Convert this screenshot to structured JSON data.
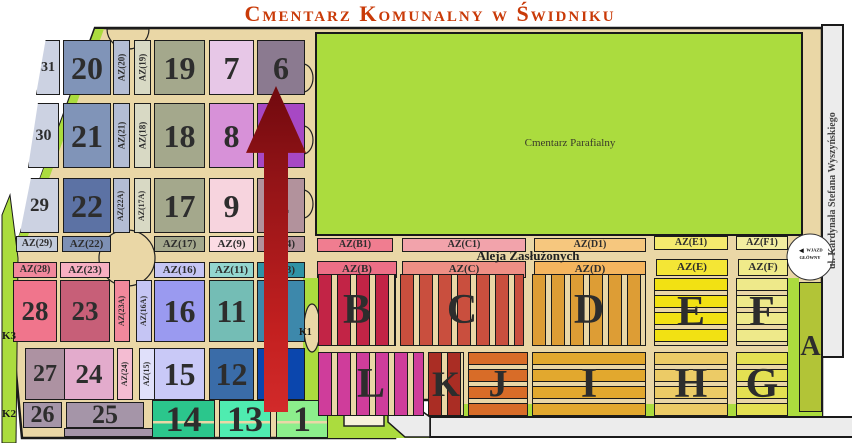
{
  "title": "Cmentarz Komunalny w Świdniku",
  "labels": {
    "parish": "Cmentarz Parafialny",
    "street_right": "ul. Kardynała Stefana Wyszyńskiego",
    "alley": "Aleja Zasłużonych",
    "entrance": "WJAZD GŁÓWNY",
    "gate_k1": "K1",
    "gate_k2": "K2",
    "gate_k3": "K3"
  },
  "colors": {
    "title": "#c93a08",
    "road_tan": "#ead7a6",
    "grass_green": "#abdc3e",
    "outline": "#1a1a1a",
    "road_gray": "#ececec",
    "arrow_red": "#c32020",
    "chapel": "#f8f1da"
  },
  "sections": [
    {
      "id": "31",
      "label": "31",
      "x": 36,
      "y": 40,
      "w": 24,
      "h": 55,
      "bg": "#ccd2e2",
      "fs": 14,
      "cp": "polygon(40% 0,100% 0,100% 100%,0 100%)"
    },
    {
      "id": "20",
      "label": "20",
      "x": 63,
      "y": 40,
      "w": 48,
      "h": 55,
      "bg": "#8094b8",
      "fs": 32
    },
    {
      "id": "az20",
      "label": "AZ(20)",
      "x": 113,
      "y": 40,
      "w": 17,
      "h": 55,
      "bg": "#b4bdd4",
      "fs": 9,
      "vert": true
    },
    {
      "id": "az19",
      "label": "AZ(19)",
      "x": 134,
      "y": 40,
      "w": 17,
      "h": 55,
      "bg": "#d8d9c4",
      "fs": 9,
      "vert": true
    },
    {
      "id": "19",
      "label": "19",
      "x": 154,
      "y": 40,
      "w": 51,
      "h": 55,
      "bg": "#a4a88c",
      "fs": 32
    },
    {
      "id": "7",
      "label": "7",
      "x": 209,
      "y": 40,
      "w": 45,
      "h": 55,
      "bg": "#e7c7e7",
      "fs": 32
    },
    {
      "id": "6",
      "label": "6",
      "x": 257,
      "y": 40,
      "w": 48,
      "h": 55,
      "bg": "#8b7a90",
      "fs": 32
    },
    {
      "id": "30",
      "label": "30",
      "x": 28,
      "y": 103,
      "w": 31,
      "h": 65,
      "bg": "#ccd2e2",
      "fs": 16,
      "cp": "polygon(32% 0,100% 0,100% 100%,0 100%)"
    },
    {
      "id": "21",
      "label": "21",
      "x": 63,
      "y": 103,
      "w": 48,
      "h": 65,
      "bg": "#8094b8",
      "fs": 32
    },
    {
      "id": "az21",
      "label": "AZ(21)",
      "x": 113,
      "y": 103,
      "w": 17,
      "h": 65,
      "bg": "#b4bdd4",
      "fs": 9,
      "vert": true
    },
    {
      "id": "az18",
      "label": "AZ(18)",
      "x": 134,
      "y": 103,
      "w": 17,
      "h": 65,
      "bg": "#d8d9c4",
      "fs": 9,
      "vert": true
    },
    {
      "id": "18",
      "label": "18",
      "x": 154,
      "y": 103,
      "w": 51,
      "h": 65,
      "bg": "#a4a88c",
      "fs": 32
    },
    {
      "id": "8",
      "label": "8",
      "x": 209,
      "y": 103,
      "w": 45,
      "h": 65,
      "bg": "#d791d8",
      "fs": 32
    },
    {
      "id": "5",
      "label": "",
      "x": 257,
      "y": 103,
      "w": 48,
      "h": 65,
      "bg": "#a748c4",
      "fs": 32
    },
    {
      "id": "29",
      "label": "29",
      "x": 20,
      "y": 178,
      "w": 39,
      "h": 55,
      "bg": "#ccd2e2",
      "fs": 19,
      "cp": "polygon(28% 0,100% 0,100% 100%,0 100%)"
    },
    {
      "id": "22",
      "label": "22",
      "x": 63,
      "y": 178,
      "w": 48,
      "h": 55,
      "bg": "#5c72a4",
      "fs": 32
    },
    {
      "id": "az22a",
      "label": "AZ(22A)",
      "x": 113,
      "y": 178,
      "w": 17,
      "h": 55,
      "bg": "#b4bdd4",
      "fs": 8,
      "vert": true
    },
    {
      "id": "az17a",
      "label": "AZ(17A)",
      "x": 134,
      "y": 178,
      "w": 17,
      "h": 55,
      "bg": "#d8d9c4",
      "fs": 8,
      "vert": true
    },
    {
      "id": "17",
      "label": "17",
      "x": 154,
      "y": 178,
      "w": 51,
      "h": 55,
      "bg": "#a4a88c",
      "fs": 32
    },
    {
      "id": "9",
      "label": "9",
      "x": 209,
      "y": 178,
      "w": 45,
      "h": 55,
      "bg": "#f7d4de",
      "fs": 32
    },
    {
      "id": "4",
      "label": "4",
      "x": 257,
      "y": 178,
      "w": 48,
      "h": 55,
      "bg": "#b2929c",
      "fs": 32
    },
    {
      "id": "az29",
      "label": "AZ(29)",
      "x": 16,
      "y": 236,
      "w": 42,
      "h": 16,
      "bg": "#c2cbdc",
      "fs": 10
    },
    {
      "id": "az22",
      "label": "AZ(22)",
      "x": 62,
      "y": 236,
      "w": 49,
      "h": 16,
      "bg": "#7d90b5",
      "fs": 11
    },
    {
      "id": "az17",
      "label": "AZ(17)",
      "x": 154,
      "y": 236,
      "w": 51,
      "h": 16,
      "bg": "#a4a88c",
      "fs": 11
    },
    {
      "id": "az9",
      "label": "AZ(9)",
      "x": 209,
      "y": 236,
      "w": 45,
      "h": 16,
      "bg": "#fbdce4",
      "fs": 11
    },
    {
      "id": "az4",
      "label": "AZ(4)",
      "x": 257,
      "y": 236,
      "w": 48,
      "h": 16,
      "bg": "#b2929c",
      "fs": 11
    },
    {
      "id": "azb1",
      "label": "AZ(B1)",
      "x": 317,
      "y": 238,
      "w": 76,
      "h": 14,
      "bg": "#f07d90",
      "fs": 10
    },
    {
      "id": "azc1",
      "label": "AZ(C1)",
      "x": 402,
      "y": 238,
      "w": 124,
      "h": 14,
      "bg": "#f2a3ab",
      "fs": 10
    },
    {
      "id": "azd1",
      "label": "AZ(D1)",
      "x": 534,
      "y": 238,
      "w": 112,
      "h": 14,
      "bg": "#f6c77e",
      "fs": 10
    },
    {
      "id": "aze1",
      "label": "AZ(E1)",
      "x": 654,
      "y": 236,
      "w": 74,
      "h": 14,
      "bg": "#f4ea6e",
      "fs": 10
    },
    {
      "id": "azf1",
      "label": "AZ(F1)",
      "x": 736,
      "y": 236,
      "w": 52,
      "h": 14,
      "bg": "#f2eda0",
      "fs": 10
    },
    {
      "id": "az28",
      "label": "AZ(28)",
      "x": 13,
      "y": 262,
      "w": 44,
      "h": 16,
      "bg": "#f0889c",
      "fs": 10
    },
    {
      "id": "az23",
      "label": "AZ(23)",
      "x": 60,
      "y": 262,
      "w": 50,
      "h": 16,
      "bg": "#f7afc2",
      "fs": 11
    },
    {
      "id": "az16",
      "label": "AZ(16)",
      "x": 154,
      "y": 262,
      "w": 51,
      "h": 16,
      "bg": "#c5c5f4",
      "fs": 11
    },
    {
      "id": "az11",
      "label": "AZ(11)",
      "x": 209,
      "y": 262,
      "w": 45,
      "h": 16,
      "bg": "#93d6cf",
      "fs": 11
    },
    {
      "id": "az3",
      "label": "AZ(3)",
      "x": 257,
      "y": 262,
      "w": 48,
      "h": 16,
      "bg": "#2e93a6",
      "fs": 11
    },
    {
      "id": "azb",
      "label": "AZ(B)",
      "x": 317,
      "y": 261,
      "w": 80,
      "h": 17,
      "bg": "#ec6f86",
      "fs": 11
    },
    {
      "id": "azc",
      "label": "AZ(C)",
      "x": 402,
      "y": 261,
      "w": 124,
      "h": 17,
      "bg": "#ee8f85",
      "fs": 11
    },
    {
      "id": "azd",
      "label": "AZ(D)",
      "x": 534,
      "y": 261,
      "w": 112,
      "h": 17,
      "bg": "#f5b55e",
      "fs": 11
    },
    {
      "id": "aze",
      "label": "AZ(E)",
      "x": 656,
      "y": 259,
      "w": 72,
      "h": 17,
      "bg": "#f4e635",
      "fs": 11
    },
    {
      "id": "azf",
      "label": "AZ(F)",
      "x": 738,
      "y": 259,
      "w": 50,
      "h": 17,
      "bg": "#f0ea8a",
      "fs": 11
    },
    {
      "id": "28",
      "label": "28",
      "x": 13,
      "y": 280,
      "w": 44,
      "h": 62,
      "bg": "#f0758c",
      "fs": 27
    },
    {
      "id": "23",
      "label": "23",
      "x": 60,
      "y": 280,
      "w": 50,
      "h": 62,
      "bg": "#c75f78",
      "fs": 27
    },
    {
      "id": "az23a",
      "label": "AZ(23A)",
      "x": 114,
      "y": 280,
      "w": 16,
      "h": 62,
      "bg": "#f2889c",
      "fs": 8,
      "vert": true
    },
    {
      "id": "az16a",
      "label": "AZ(16A)",
      "x": 136,
      "y": 280,
      "w": 16,
      "h": 62,
      "bg": "#c5c5f4",
      "fs": 8,
      "vert": true
    },
    {
      "id": "16",
      "label": "16",
      "x": 154,
      "y": 280,
      "w": 51,
      "h": 62,
      "bg": "#9a9af0",
      "fs": 32
    },
    {
      "id": "11",
      "label": "11",
      "x": 209,
      "y": 280,
      "w": 45,
      "h": 62,
      "bg": "#74bdb5",
      "fs": 32
    },
    {
      "id": "3",
      "label": "3",
      "x": 257,
      "y": 280,
      "w": 48,
      "h": 62,
      "bg": "#3d88ab",
      "fs": 32
    },
    {
      "id": "27",
      "label": "27",
      "x": 25,
      "y": 348,
      "w": 40,
      "h": 52,
      "bg": "#ad92a2",
      "fs": 24
    },
    {
      "id": "24",
      "label": "24",
      "x": 64,
      "y": 348,
      "w": 50,
      "h": 52,
      "bg": "#e3abcc",
      "fs": 27
    },
    {
      "id": "az24",
      "label": "AZ(24)",
      "x": 117,
      "y": 348,
      "w": 16,
      "h": 52,
      "bg": "#f4bcd2",
      "fs": 8,
      "vert": true
    },
    {
      "id": "az15",
      "label": "AZ(15)",
      "x": 139,
      "y": 348,
      "w": 16,
      "h": 52,
      "bg": "#e0e0fa",
      "fs": 8,
      "vert": true
    },
    {
      "id": "15",
      "label": "15",
      "x": 154,
      "y": 348,
      "w": 51,
      "h": 52,
      "bg": "#c9c9f7",
      "fs": 32
    },
    {
      "id": "12",
      "label": "12",
      "x": 209,
      "y": 348,
      "w": 45,
      "h": 52,
      "bg": "#3a6ca8",
      "fs": 32
    },
    {
      "id": "2",
      "label": "2",
      "x": 257,
      "y": 348,
      "w": 48,
      "h": 52,
      "bg": "#0b46ad",
      "fs": 32
    },
    {
      "id": "26",
      "label": "26",
      "x": 23,
      "y": 402,
      "w": 39,
      "h": 26,
      "bg": "#a595a8",
      "fs": 24
    },
    {
      "id": "25",
      "label": "25",
      "x": 66,
      "y": 402,
      "w": 78,
      "h": 26,
      "bg": "#a595a8",
      "fs": 26
    },
    {
      "id": "25a",
      "label": "",
      "x": 64,
      "y": 428,
      "w": 148,
      "h": 9,
      "bg": "#a595a8",
      "fs": 8
    },
    {
      "id": "14",
      "label": "14",
      "x": 152,
      "y": 400,
      "w": 63,
      "h": 38,
      "bg": "#2bc68c",
      "fs": 36,
      "split": true
    },
    {
      "id": "13",
      "label": "13",
      "x": 219,
      "y": 400,
      "w": 52,
      "h": 38,
      "bg": "#4fecb0",
      "fs": 36,
      "split": true
    },
    {
      "id": "1",
      "label": "1",
      "x": 276,
      "y": 400,
      "w": 52,
      "h": 38,
      "bg": "#8cee8c",
      "fs": 36,
      "split": true
    },
    {
      "id": "B",
      "label": "B",
      "x": 318,
      "y": 274,
      "w": 78,
      "h": 72,
      "bg": "#c22446",
      "fs": 42,
      "stripe": "v"
    },
    {
      "id": "C",
      "label": "C",
      "x": 400,
      "y": 274,
      "w": 124,
      "h": 72,
      "bg": "#c94f3e",
      "fs": 42,
      "stripe": "v"
    },
    {
      "id": "D",
      "label": "D",
      "x": 532,
      "y": 274,
      "w": 114,
      "h": 72,
      "bg": "#dd9d35",
      "fs": 42,
      "stripe": "v"
    },
    {
      "id": "E",
      "label": "E",
      "x": 654,
      "y": 278,
      "w": 74,
      "h": 68,
      "bg": "#f2e113",
      "fs": 42,
      "stripe": "h"
    },
    {
      "id": "F",
      "label": "F",
      "x": 736,
      "y": 278,
      "w": 52,
      "h": 68,
      "bg": "#eee98a",
      "fs": 42,
      "stripe": "h"
    },
    {
      "id": "L",
      "label": "L",
      "x": 318,
      "y": 352,
      "w": 106,
      "h": 64,
      "bg": "#cf3d9b",
      "fs": 42,
      "stripe": "v"
    },
    {
      "id": "K",
      "label": "K",
      "x": 428,
      "y": 352,
      "w": 36,
      "h": 64,
      "bg": "#aa2d24",
      "fs": 36,
      "stripe": "v"
    },
    {
      "id": "J",
      "label": "J",
      "x": 468,
      "y": 352,
      "w": 60,
      "h": 64,
      "bg": "#d86c28",
      "fs": 38,
      "stripe": "h"
    },
    {
      "id": "I",
      "label": "I",
      "x": 532,
      "y": 352,
      "w": 114,
      "h": 64,
      "bg": "#e2a82e",
      "fs": 42,
      "stripe": "h"
    },
    {
      "id": "H",
      "label": "H",
      "x": 654,
      "y": 352,
      "w": 74,
      "h": 64,
      "bg": "#eccb66",
      "fs": 42,
      "stripe": "h"
    },
    {
      "id": "G",
      "label": "G",
      "x": 736,
      "y": 352,
      "w": 52,
      "h": 64,
      "bg": "#e4e052",
      "fs": 42,
      "stripe": "h"
    },
    {
      "id": "A",
      "label": "A",
      "x": 799,
      "y": 282,
      "w": 23,
      "h": 130,
      "bg": "#b2c437",
      "fs": 28
    }
  ]
}
